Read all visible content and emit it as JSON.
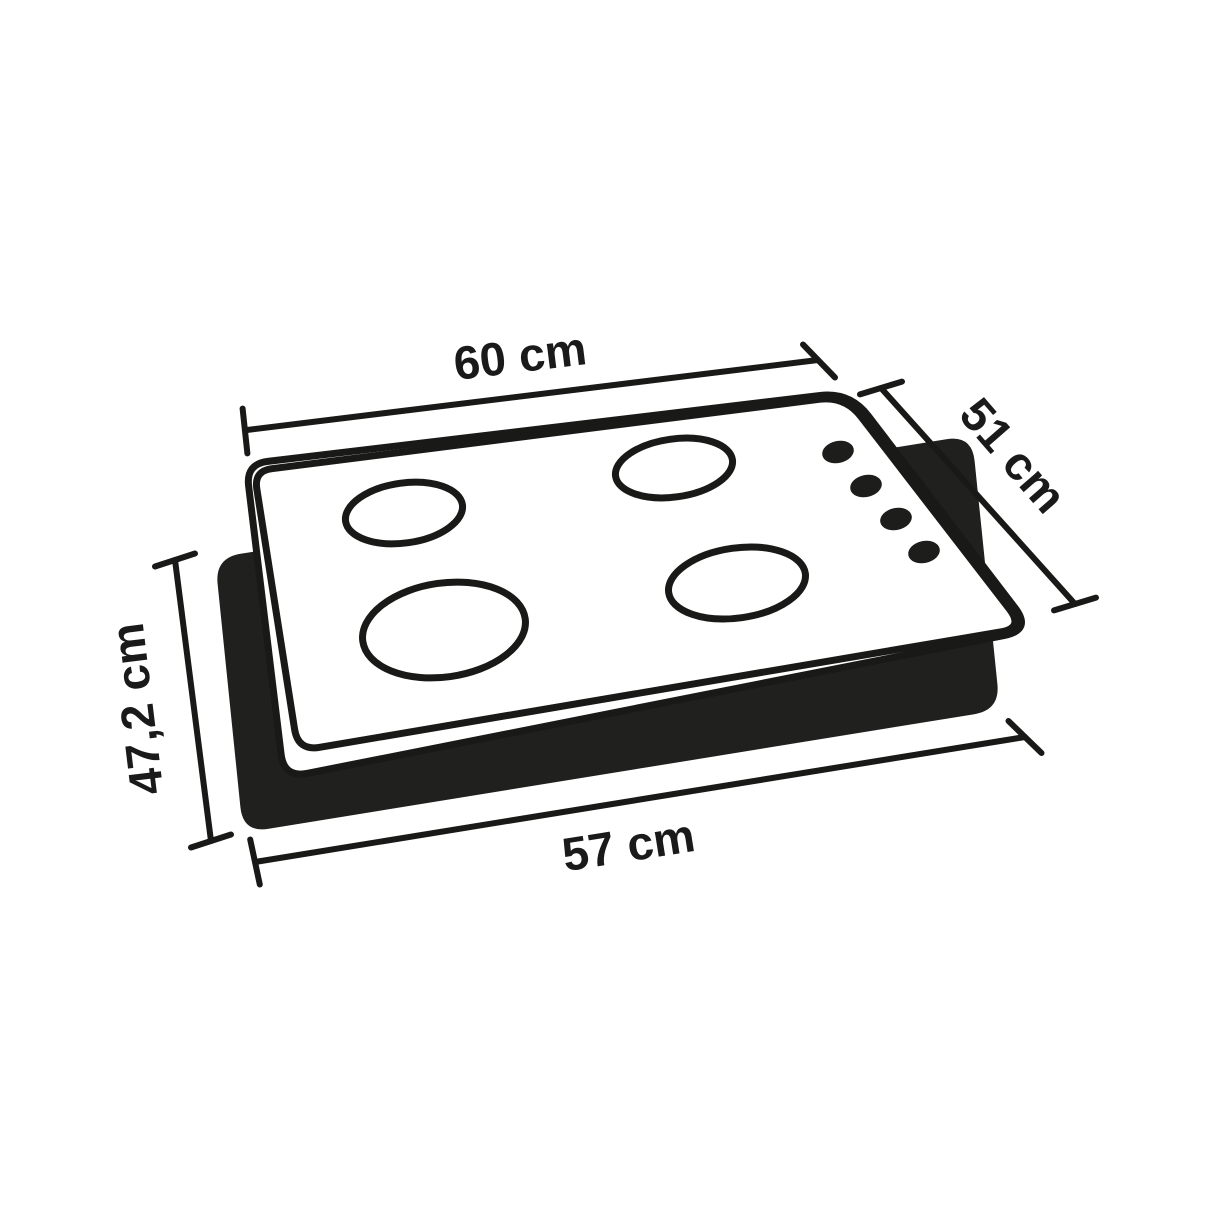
{
  "diagram": {
    "title": "Gas cooktop dimension diagram",
    "colors": {
      "line": "#191918",
      "panel": "#20201e",
      "surface": "#ffffff",
      "text": "#1a1a1a"
    },
    "dimensions": {
      "top_width": {
        "label": "60 cm"
      },
      "right_depth": {
        "label": "51 cm"
      },
      "left_cutout": {
        "label": "47,2 cm"
      },
      "bottom_cutout": {
        "label": "57 cm"
      }
    },
    "burner_count": 4,
    "knob_count": 4
  }
}
